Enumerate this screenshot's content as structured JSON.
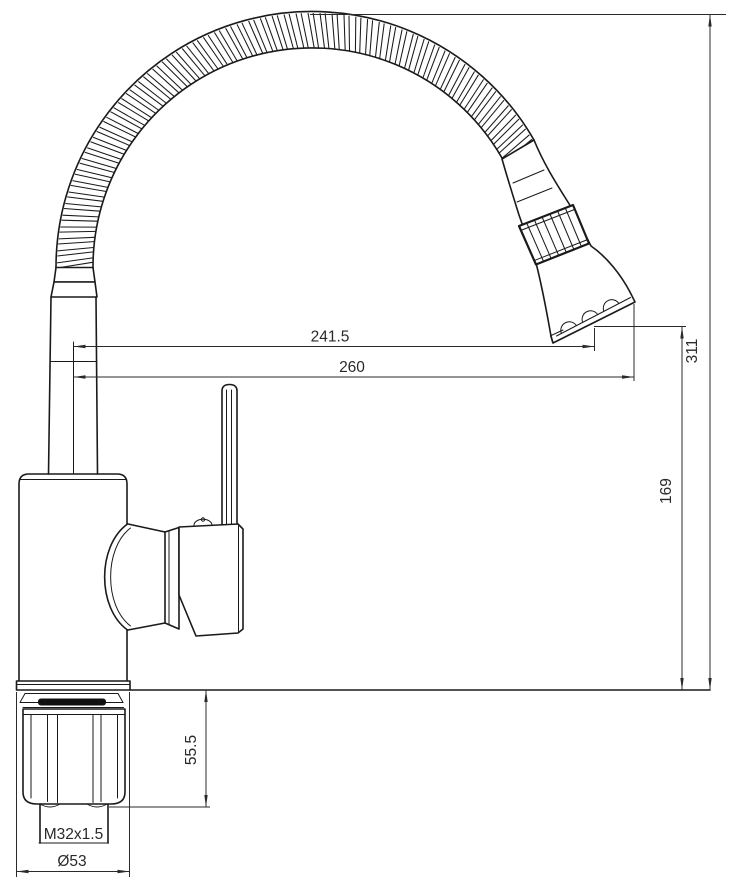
{
  "drawing": {
    "type": "technical-dimension-drawing",
    "subject": "kitchen-faucet-with-flexible-spout",
    "dimensions": {
      "spout_reach_to_nozzle": "241.5",
      "spout_reach_overall": "260",
      "overall_height": "311",
      "nozzle_height_above_deck": "169",
      "under_deck_shank_length": "55.5",
      "shank_thread": "M32x1.5",
      "base_diameter": "Ø53"
    },
    "colors": {
      "line": "#1a1a1a",
      "dim_line": "#2a2a2a",
      "background": "#ffffff",
      "gasket_fill": "#111111"
    }
  }
}
